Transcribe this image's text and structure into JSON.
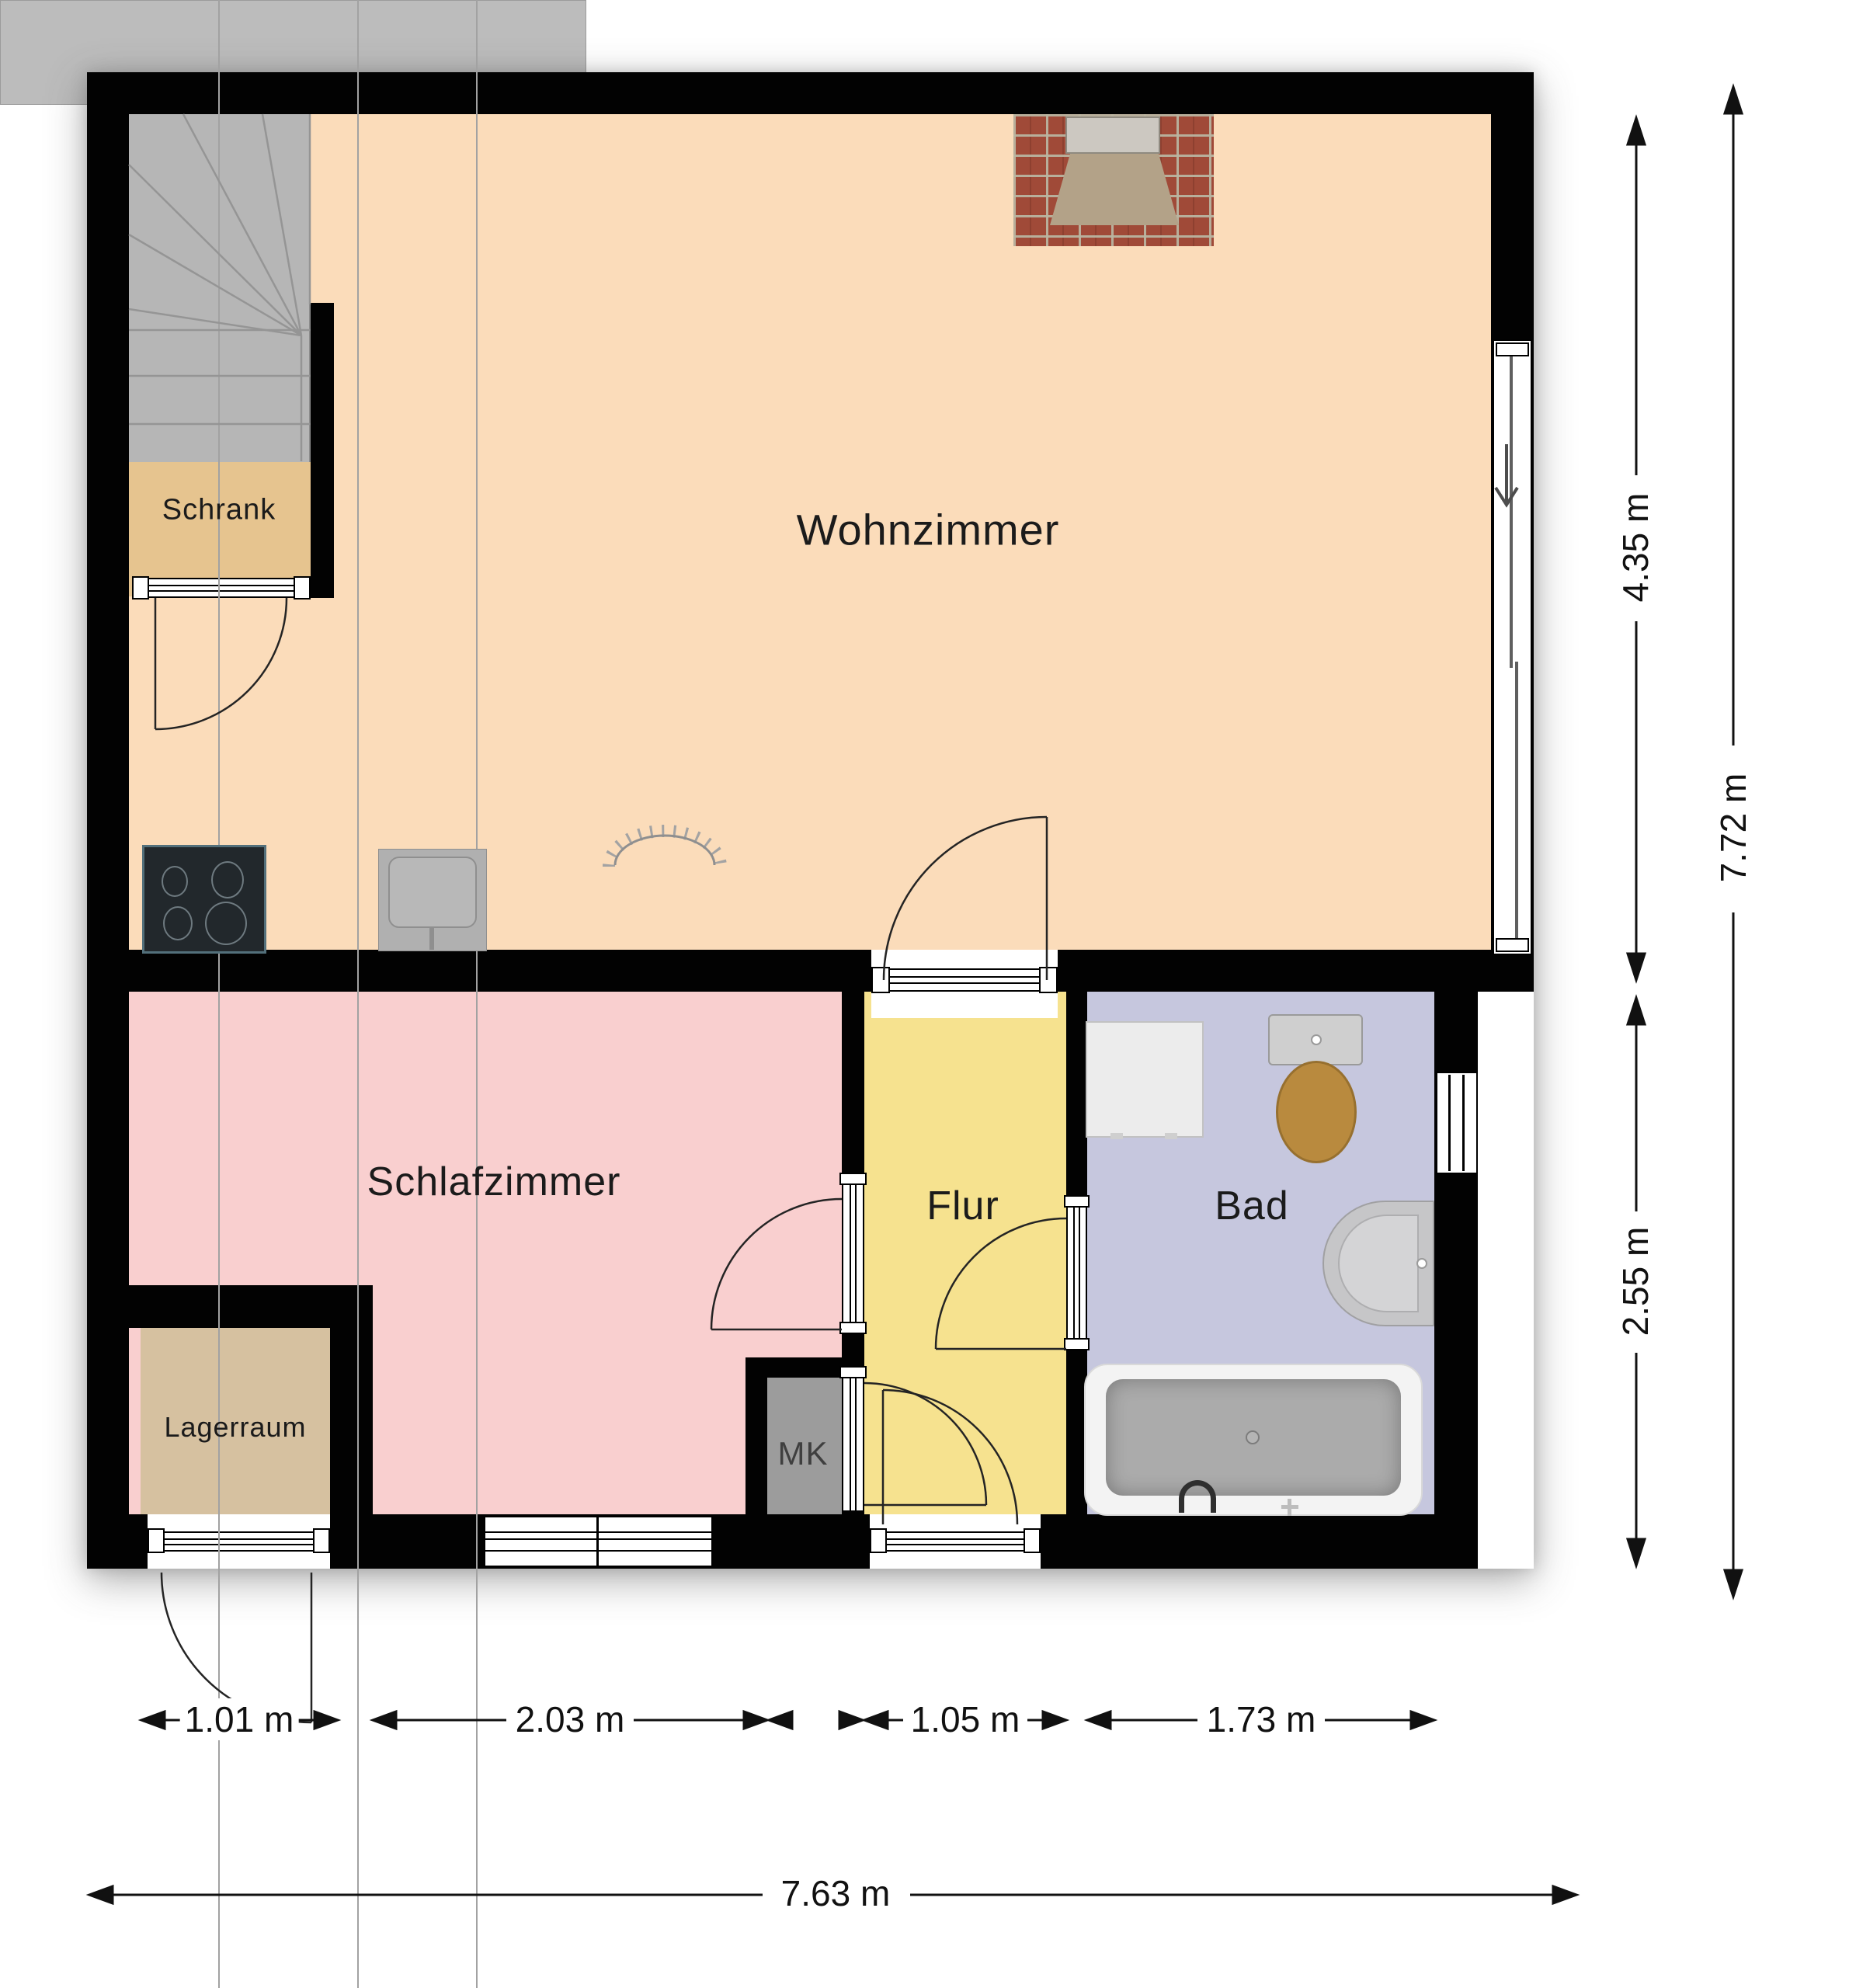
{
  "plan": {
    "rooms": {
      "wohnzimmer": {
        "label": "Wohnzimmer"
      },
      "schlafzimmer": {
        "label": "Schlafzimmer"
      },
      "flur": {
        "label": "Flur"
      },
      "bad": {
        "label": "Bad"
      },
      "schrank": {
        "label": "Schrank"
      },
      "lagerraum": {
        "label": "Lagerraum"
      },
      "mk": {
        "label": "MK"
      }
    },
    "dimensions": {
      "right_upper": {
        "label": "4.35 m"
      },
      "right_lower": {
        "label": "2.55 m"
      },
      "right_total": {
        "label": "7.72 m"
      },
      "bottom_seg1": {
        "label": "1.01 m"
      },
      "bottom_seg2": {
        "label": "2.03 m"
      },
      "bottom_seg3": {
        "label": "1.05 m"
      },
      "bottom_seg4": {
        "label": "1.73 m"
      },
      "bottom_total": {
        "label": "7.63 m"
      }
    },
    "fixtures": [
      "staircase",
      "closet-sliding-door",
      "fireplace",
      "kitchen-counter",
      "cooktop",
      "kitchen-sink",
      "dish-drainer",
      "sliding-glass-door",
      "washing-machine",
      "toilet",
      "washbasin",
      "bathtub",
      "bathroom-window",
      "bedroom-window",
      "entrance-door",
      "storage-door",
      "meter-cabinet"
    ],
    "colors": {
      "wall": "#020202",
      "wohnzimmer_floor": "#fbdcba",
      "schlafzimmer_floor": "#f9cfcf",
      "flur_floor": "#f6e28f",
      "bad_floor": "#c6c7de",
      "schrank_floor": "#e6c48f",
      "lagerraum_floor": "#d6c1a0",
      "stairs": "#b6b6b6",
      "meter_cabinet": "#9c9c9c",
      "toilet_seat": "#b98a3e",
      "fireplace_brick": "#a04a38"
    }
  }
}
